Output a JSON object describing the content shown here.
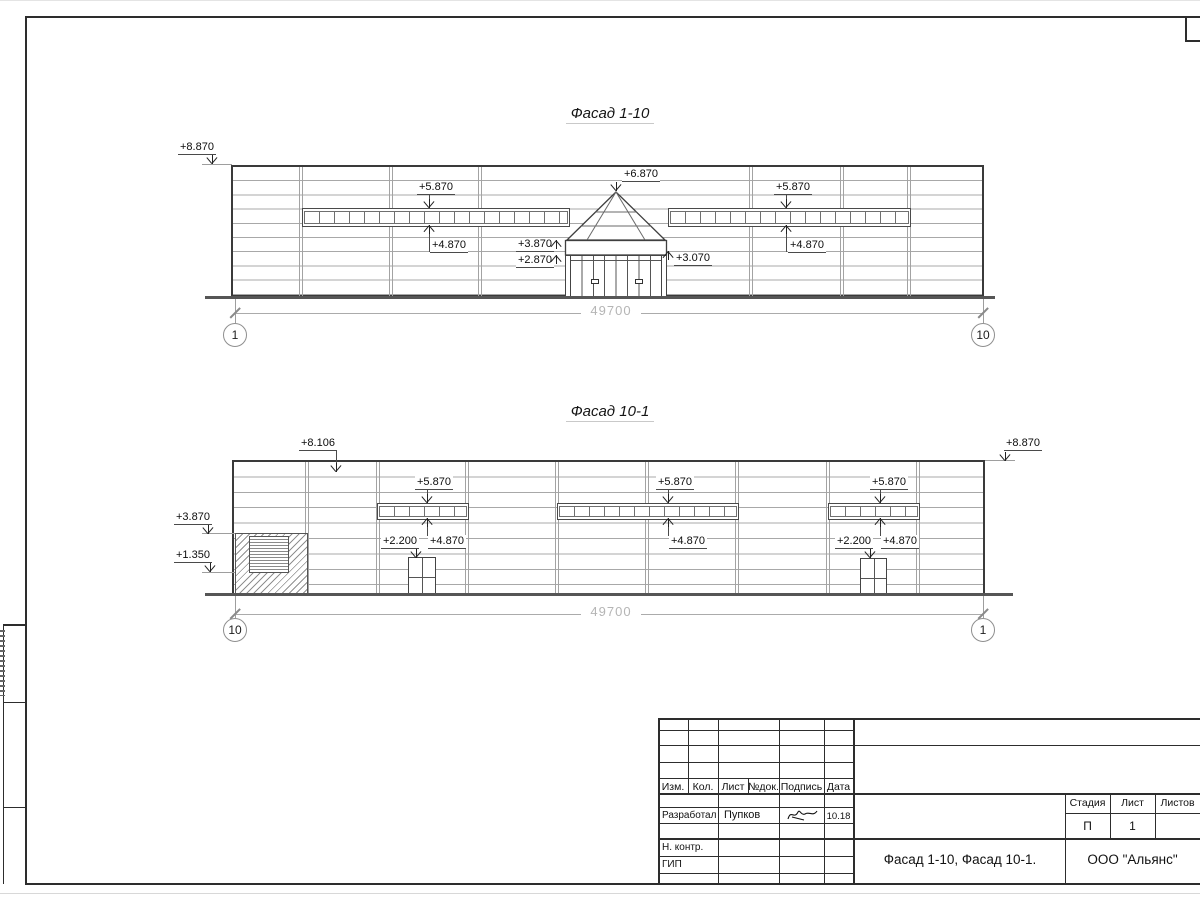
{
  "facade1": {
    "title": "Фасад 1-10",
    "elev_roof": "+8.870",
    "elev_window_top_left": "+5.870",
    "elev_window_bottom_left": "+4.870",
    "elev_entrance_apex": "+6.870",
    "elev_canopy_top": "+3.870",
    "elev_canopy_bottom": "+2.870",
    "elev_canopy_right": "+3.070",
    "elev_window_top_right": "+5.870",
    "elev_window_bottom_right": "+4.870",
    "dim_total": "49700",
    "axis_left": "1",
    "axis_right": "10"
  },
  "facade2": {
    "title": "Фасад 10-1",
    "elev_parapet": "+8.106",
    "elev_roof_right": "+8.870",
    "elev_gate_top": "+3.870",
    "elev_gate_bottom": "+1.350",
    "elev_window_top_a": "+5.870",
    "elev_window_bottom_a": "+4.870",
    "elev_door_a": "+2.200",
    "elev_window_top_b": "+5.870",
    "elev_window_bottom_b": "+4.870",
    "elev_window_top_c": "+5.870",
    "elev_window_bottom_c": "+4.870",
    "elev_door_c": "+2.200",
    "dim_total": "49700",
    "axis_left": "10",
    "axis_right": "1"
  },
  "title_block": {
    "col_izm": "Изм.",
    "col_kol": "Кол.",
    "col_list": "Лист",
    "col_ndok": "№док.",
    "col_podpis": "Подпись",
    "col_data": "Дата",
    "developed_label": "Разработал",
    "developed_name": "Пупков",
    "developed_date": "10.18",
    "ncontr_label": "Н. контр.",
    "gip_label": "ГИП",
    "stage_label": "Стадия",
    "sheet_label": "Лист",
    "sheets_label": "Листов",
    "stage_value": "П",
    "sheet_value": "1",
    "doc_title": "Фасад 1-10, Фасад 10-1.",
    "company": "ООО \"Альянс\""
  }
}
